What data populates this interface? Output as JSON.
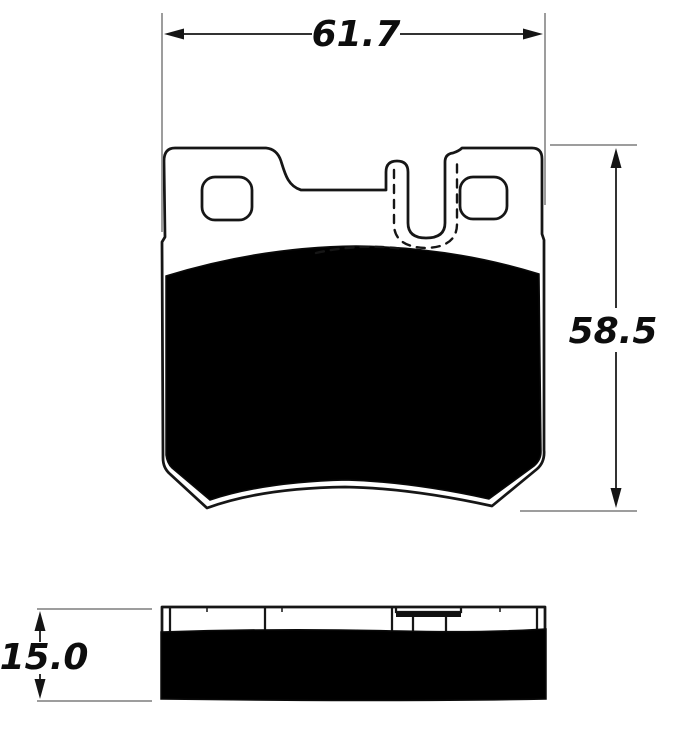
{
  "drawing": {
    "type": "technical-dimension-drawing",
    "subject": "brake-pad",
    "views": [
      {
        "id": "front-view",
        "description": "Brake pad front view: backing plate with two mounting tabs, two rounded mounting holes, center spring finger with U-notch (hidden edges dashed), black friction material"
      },
      {
        "id": "side-view",
        "description": "Brake pad side/edge view: backing plate strip with retaining clip detail above solid friction material block"
      }
    ],
    "dimensions": {
      "width": {
        "label": "61.7",
        "position": "top"
      },
      "height": {
        "label": "58.5",
        "position": "right"
      },
      "thickness": {
        "label": "15.0",
        "position": "left"
      }
    },
    "colors": {
      "outline": "#161616",
      "friction_fill": "#000000",
      "extension_line": "#8f8f8f",
      "dimension_line": "#151515",
      "background": "#ffffff"
    }
  }
}
